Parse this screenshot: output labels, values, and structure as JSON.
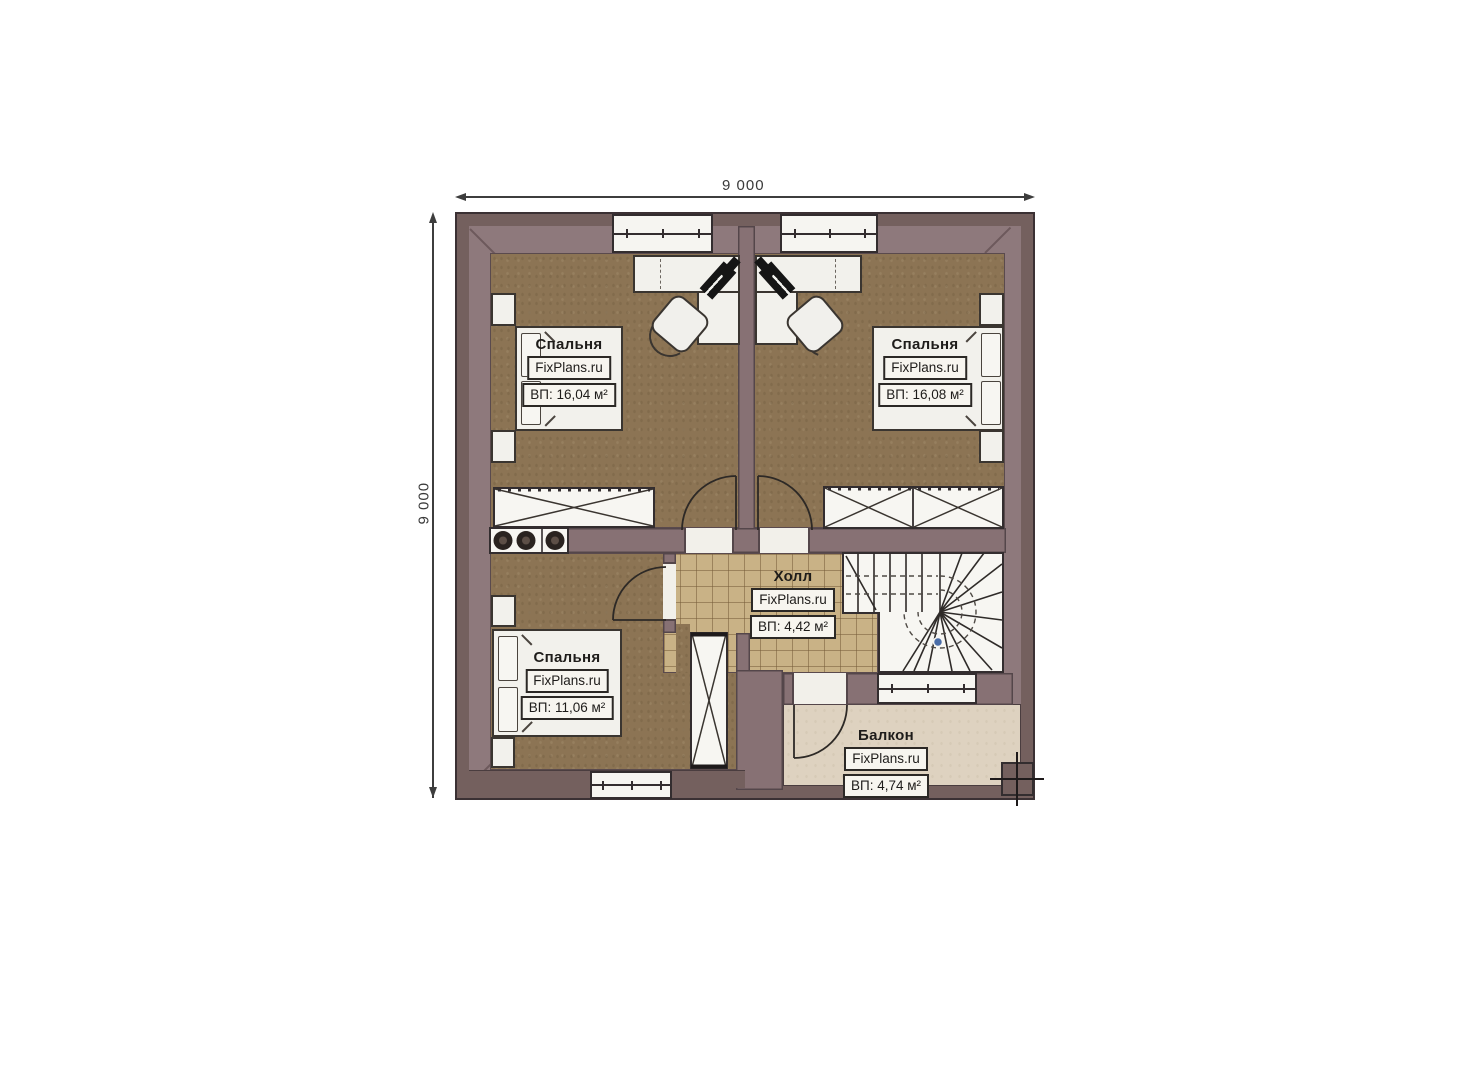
{
  "dimensions": {
    "width_label": "9 000",
    "height_label": "9 000"
  },
  "rooms": [
    {
      "id": "bedroom-top-left",
      "name": "Спальня",
      "brand": "FixPlans.ru",
      "area": "ВП: 16,04 м²"
    },
    {
      "id": "bedroom-top-right",
      "name": "Спальня",
      "brand": "FixPlans.ru",
      "area": "ВП: 16,08 м²"
    },
    {
      "id": "bedroom-bottom-left",
      "name": "Спальня",
      "brand": "FixPlans.ru",
      "area": "ВП: 11,06 м²"
    },
    {
      "id": "hall",
      "name": "Холл",
      "brand": "FixPlans.ru",
      "area": "ВП: 4,42 м²"
    },
    {
      "id": "balcony",
      "name": "Балкон",
      "brand": "FixPlans.ru",
      "area": "ВП: 4,74 м²"
    }
  ],
  "colors": {
    "wall_dark": "#74605e",
    "wall_light": "#8e797c",
    "wood_floor": "#8c7454",
    "tile_floor": "#c9b286",
    "balcony_floor": "#ded2c0",
    "furniture_white": "#f2f1ec",
    "line_dark": "#332d2f",
    "stair_marker_blue": "#4a6da8"
  }
}
